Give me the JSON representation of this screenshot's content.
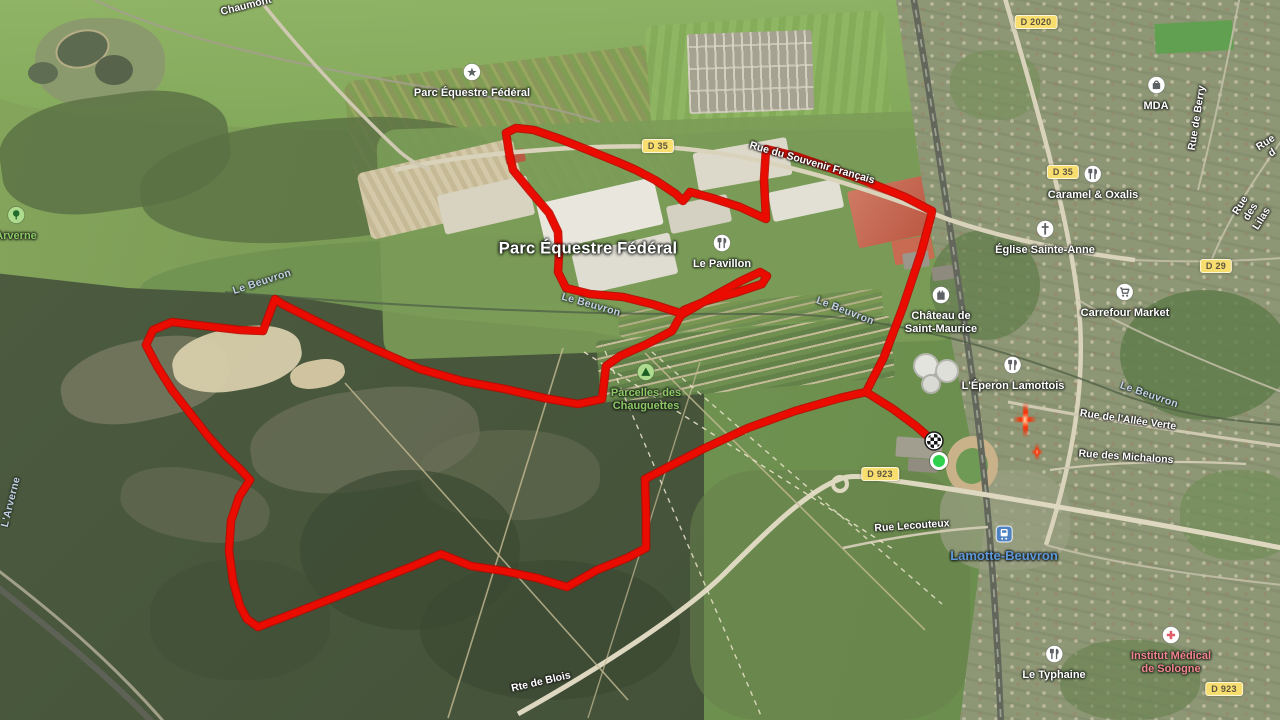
{
  "app": {
    "type": "satellite-map-with-gps-route",
    "place": "Lamotte-Beuvron"
  },
  "route": {
    "color": "#ea0c00",
    "edge_color": "#bd0800",
    "points": [
      [
        933,
        441
      ],
      [
        916,
        426
      ],
      [
        893,
        409
      ],
      [
        866,
        392
      ],
      [
        884,
        357
      ],
      [
        903,
        307
      ],
      [
        921,
        253
      ],
      [
        931,
        216
      ],
      [
        932,
        211
      ],
      [
        905,
        197
      ],
      [
        868,
        182
      ],
      [
        830,
        168
      ],
      [
        795,
        156
      ],
      [
        766,
        149
      ],
      [
        764,
        180
      ],
      [
        766,
        219
      ],
      [
        740,
        207
      ],
      [
        712,
        198
      ],
      [
        690,
        192
      ],
      [
        683,
        201
      ],
      [
        676,
        194
      ],
      [
        655,
        180
      ],
      [
        636,
        170
      ],
      [
        620,
        163
      ],
      [
        588,
        150
      ],
      [
        560,
        139
      ],
      [
        534,
        130
      ],
      [
        516,
        128
      ],
      [
        506,
        133
      ],
      [
        509,
        152
      ],
      [
        513,
        170
      ],
      [
        531,
        192
      ],
      [
        549,
        213
      ],
      [
        558,
        232
      ],
      [
        559,
        255
      ],
      [
        558,
        272
      ],
      [
        566,
        288
      ],
      [
        590,
        294
      ],
      [
        623,
        297
      ],
      [
        652,
        304
      ],
      [
        683,
        314
      ],
      [
        712,
        297
      ],
      [
        741,
        281
      ],
      [
        760,
        272
      ],
      [
        767,
        276
      ],
      [
        762,
        284
      ],
      [
        735,
        293
      ],
      [
        706,
        301
      ],
      [
        684,
        310
      ],
      [
        672,
        331
      ],
      [
        647,
        344
      ],
      [
        620,
        356
      ],
      [
        606,
        366
      ],
      [
        604,
        383
      ],
      [
        602,
        399
      ],
      [
        578,
        404
      ],
      [
        544,
        398
      ],
      [
        505,
        389
      ],
      [
        462,
        381
      ],
      [
        420,
        369
      ],
      [
        372,
        348
      ],
      [
        320,
        323
      ],
      [
        282,
        304
      ],
      [
        275,
        299
      ],
      [
        263,
        331
      ],
      [
        240,
        330
      ],
      [
        205,
        326
      ],
      [
        172,
        322
      ],
      [
        153,
        330
      ],
      [
        146,
        345
      ],
      [
        157,
        366
      ],
      [
        172,
        390
      ],
      [
        190,
        413
      ],
      [
        208,
        436
      ],
      [
        225,
        455
      ],
      [
        240,
        469
      ],
      [
        250,
        480
      ],
      [
        239,
        497
      ],
      [
        231,
        521
      ],
      [
        229,
        551
      ],
      [
        233,
        581
      ],
      [
        240,
        606
      ],
      [
        247,
        619
      ],
      [
        258,
        627
      ],
      [
        292,
        614
      ],
      [
        333,
        598
      ],
      [
        375,
        581
      ],
      [
        413,
        566
      ],
      [
        441,
        554
      ],
      [
        471,
        566
      ],
      [
        504,
        571
      ],
      [
        537,
        578
      ],
      [
        567,
        587
      ],
      [
        597,
        570
      ],
      [
        627,
        558
      ],
      [
        646,
        548
      ],
      [
        646,
        515
      ],
      [
        645,
        479
      ],
      [
        670,
        466
      ],
      [
        703,
        449
      ],
      [
        748,
        428
      ],
      [
        795,
        411
      ],
      [
        840,
        398
      ],
      [
        866,
        392
      ],
      [
        893,
        409
      ],
      [
        916,
        426
      ],
      [
        933,
        441
      ]
    ]
  },
  "markers": {
    "start": {
      "x": 939,
      "y": 461,
      "color": "#2fd14c"
    },
    "finish": {
      "x": 934,
      "y": 441
    }
  },
  "road_badges": [
    {
      "label": "D 35",
      "x": 658,
      "y": 146
    },
    {
      "label": "D 2020",
      "x": 1036,
      "y": 22
    },
    {
      "label": "D 35",
      "x": 1063,
      "y": 172
    },
    {
      "label": "D 29",
      "x": 1216,
      "y": 266
    },
    {
      "label": "D 923",
      "x": 880,
      "y": 474
    },
    {
      "label": "D 923",
      "x": 1224,
      "y": 689
    }
  ],
  "road_labels": [
    {
      "text": "Chaumont",
      "x": 246,
      "y": 6,
      "rot": -14
    },
    {
      "text": "Rue du Souvenir Français",
      "x": 812,
      "y": 163,
      "rot": 16
    },
    {
      "text": "Rue de Berry",
      "x": 1197,
      "y": 118,
      "rot": -81
    },
    {
      "text": "Rue d",
      "x": 1269,
      "y": 148,
      "rot": -33
    },
    {
      "text": "Rue des Lilas",
      "x": 1251,
      "y": 212,
      "rot": -58
    },
    {
      "text": "Rue de l'Allée Verte",
      "x": 1128,
      "y": 420,
      "rot": 8
    },
    {
      "text": "Rue des Michalons",
      "x": 1126,
      "y": 457,
      "rot": 4
    },
    {
      "text": "Rue Lecouteux",
      "x": 912,
      "y": 526,
      "rot": -4
    },
    {
      "text": "Rte de Blois",
      "x": 541,
      "y": 682,
      "rot": -13
    }
  ],
  "water_labels": [
    {
      "text": "Le Beuvron",
      "x": 262,
      "y": 282,
      "rot": -18
    },
    {
      "text": "Le Beuvron",
      "x": 591,
      "y": 305,
      "rot": 16
    },
    {
      "text": "Le Beuvron",
      "x": 845,
      "y": 311,
      "rot": 21
    },
    {
      "text": "Le Beuvron",
      "x": 1149,
      "y": 395,
      "rot": 19
    },
    {
      "text": "L'Arverne",
      "x": 11,
      "y": 502,
      "rot": -76
    }
  ],
  "area_labels": [
    {
      "text": "Parc Équestre Fédéral",
      "x": 588,
      "y": 249
    }
  ],
  "pois": [
    {
      "icon": "equestrian",
      "text": "Parc Équestre Fédéral",
      "x": 472,
      "y": 63,
      "cls": ""
    },
    {
      "icon": "store",
      "text": "MDA",
      "x": 1156,
      "y": 76,
      "cls": ""
    },
    {
      "icon": "restaurant",
      "text": "Caramel & Oxalis",
      "x": 1093,
      "y": 165,
      "cls": ""
    },
    {
      "icon": "church",
      "text": "Église Sainte-Anne",
      "x": 1045,
      "y": 220,
      "cls": ""
    },
    {
      "icon": "cart",
      "text": "Carrefour Market",
      "x": 1125,
      "y": 283,
      "cls": ""
    },
    {
      "icon": "restaurant",
      "text": "Le Pavillon",
      "x": 722,
      "y": 234,
      "cls": ""
    },
    {
      "icon": "castle",
      "text": "Château de\nSaint-Maurice",
      "x": 941,
      "y": 286,
      "cls": ""
    },
    {
      "icon": "restaurant",
      "text": "L'Éperon Lamottois",
      "x": 1013,
      "y": 356,
      "cls": ""
    },
    {
      "icon": "train",
      "text": "Lamotte-Beuvron",
      "x": 1004,
      "y": 525,
      "cls": "town"
    },
    {
      "icon": "restaurant",
      "text": "Le Typhaine",
      "x": 1054,
      "y": 645,
      "cls": ""
    },
    {
      "icon": "hospital",
      "text": "Institut Médical\nde Sologne",
      "x": 1171,
      "y": 626,
      "cls": "hospital"
    },
    {
      "icon": "tree",
      "text": "Arverne",
      "x": 16,
      "y": 206,
      "cls": "park"
    },
    {
      "icon": "tent",
      "text": "Parcelles des\nChauguettes",
      "x": 646,
      "y": 363,
      "cls": "park"
    }
  ],
  "colors": {
    "route_red": "#ea0c00",
    "badge_yellow": "#f7de6e",
    "water_label": "#c3d0e4",
    "park_label": "#8cc964",
    "hospital_label": "#f0858c",
    "town_label": "#5f98d8"
  }
}
